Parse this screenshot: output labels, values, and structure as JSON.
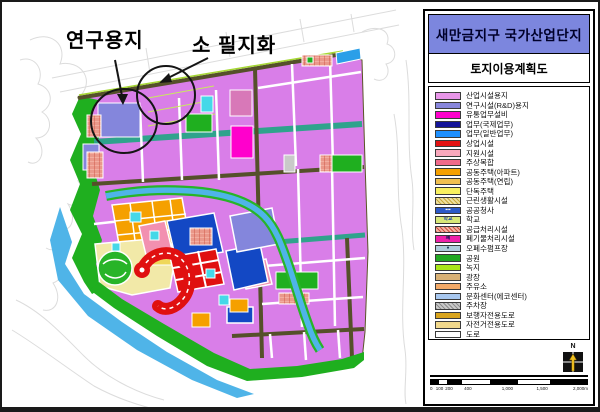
{
  "map": {
    "annotations": [
      {
        "label": "연구용지"
      },
      {
        "label": "소 필지화"
      }
    ]
  },
  "panel": {
    "title": "새만금지구 국가산업단지",
    "subtitle": "토지이용계획도",
    "colors": {
      "title_bg": "#7C86DE",
      "industrial": "#D97EE8",
      "research": "#8486DC",
      "park": "#1FAF1F",
      "water": "#4FB4E8"
    },
    "legend": {
      "items": [
        {
          "label": "산업시설용지",
          "color": "#E996E9"
        },
        {
          "label": "연구시설(R&D)용지",
          "color": "#8886DC"
        },
        {
          "label": "유통업무설비",
          "color": "#FF00CC"
        },
        {
          "label": "업무(국제업무)",
          "color": "#141499"
        },
        {
          "label": "업무(일반업무)",
          "color": "#1E90FF"
        },
        {
          "label": "상업시설",
          "color": "#E31212"
        },
        {
          "label": "지원시설",
          "color": "#F9A8BC"
        },
        {
          "label": "주상복합",
          "color": "#F06A8A"
        },
        {
          "label": "공동주택(아파트)",
          "color": "#F5A000"
        },
        {
          "label": "공동주택(연립)",
          "color": "#F0C050"
        },
        {
          "label": "단독주택",
          "color": "#F8F060"
        },
        {
          "label": "근린생활시설",
          "color": "#EDE0A0",
          "hatch": true,
          "hatch_color": "#C8A83C"
        },
        {
          "label": "공공청사",
          "color": "#2B59C8",
          "glyph": "▪▪▪",
          "glyph_color": "#FFFFFF"
        },
        {
          "label": "학교",
          "color": "#D8E878",
          "glyph": "학교",
          "glyph_color": "#2244AA"
        },
        {
          "label": "공급처리시설",
          "color": "#F4B4A4",
          "hatch": true,
          "hatch_color": "#CC5040"
        },
        {
          "label": "폐기물처리시설",
          "color": "#EE22AA",
          "glyph": "폐",
          "glyph_color": "#14145A"
        },
        {
          "label": "오폐수펌프장",
          "color": "#AECCDC",
          "glyph": "●",
          "glyph_color": "#204060"
        },
        {
          "label": "공원",
          "color": "#22A822"
        },
        {
          "label": "녹지",
          "color": "#A9E619"
        },
        {
          "label": "광장",
          "color": "#D9B175"
        },
        {
          "label": "주유소",
          "color": "#F2A968"
        },
        {
          "label": "문화센터(에코센터)",
          "color": "#A8C8F0"
        },
        {
          "label": "주차장",
          "color": "#C9C9C9",
          "hatch": true,
          "hatch_color": "#8C8C8C"
        },
        {
          "label": "보행자전용도로",
          "color": "#D9A41C"
        },
        {
          "label": "자전거전용도로",
          "color": "#F2D98C"
        },
        {
          "label": "도로",
          "color": "#FFFFFF"
        }
      ]
    },
    "north_label": "N",
    "scalebar": {
      "labels": [
        "0",
        "100",
        "200",
        "400",
        "1,000",
        "1,500",
        "2,000m"
      ]
    }
  }
}
